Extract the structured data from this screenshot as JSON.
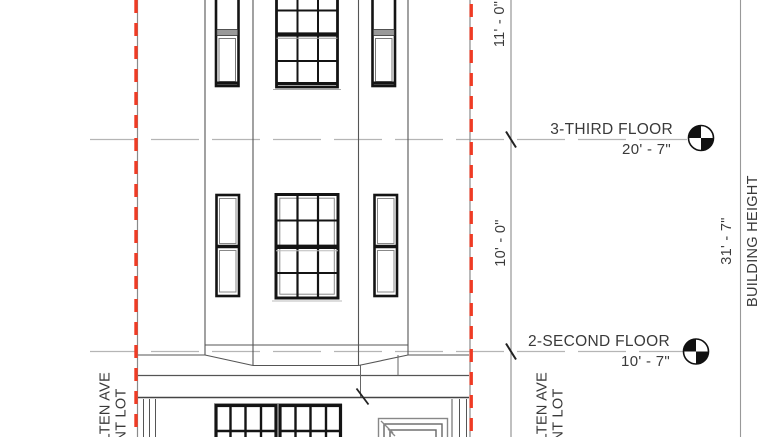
{
  "levels": [
    {
      "label": "3-THIRD FLOOR",
      "elevation": "20' - 7\""
    },
    {
      "label": "2-SECOND FLOOR",
      "elevation": "10' - 7\""
    }
  ],
  "floor_heights": {
    "third_to_roof": "11' - 0\"",
    "second_to_third": "10' - 0\""
  },
  "building_height": {
    "value": "31' - 7\"",
    "label": "BUILDING HEIGHT"
  },
  "adjacent_lot": {
    "left": {
      "line1": "LTEN AVE",
      "line2": "NT LOT"
    },
    "right": {
      "line1": "LTEN AVE",
      "line2": "NT LOT"
    }
  },
  "colors": {
    "lot_line_red": "#ef3b24",
    "line_dark": "#3c3c3c",
    "line_light": "#b5b5b5",
    "window_black": "#141414"
  }
}
